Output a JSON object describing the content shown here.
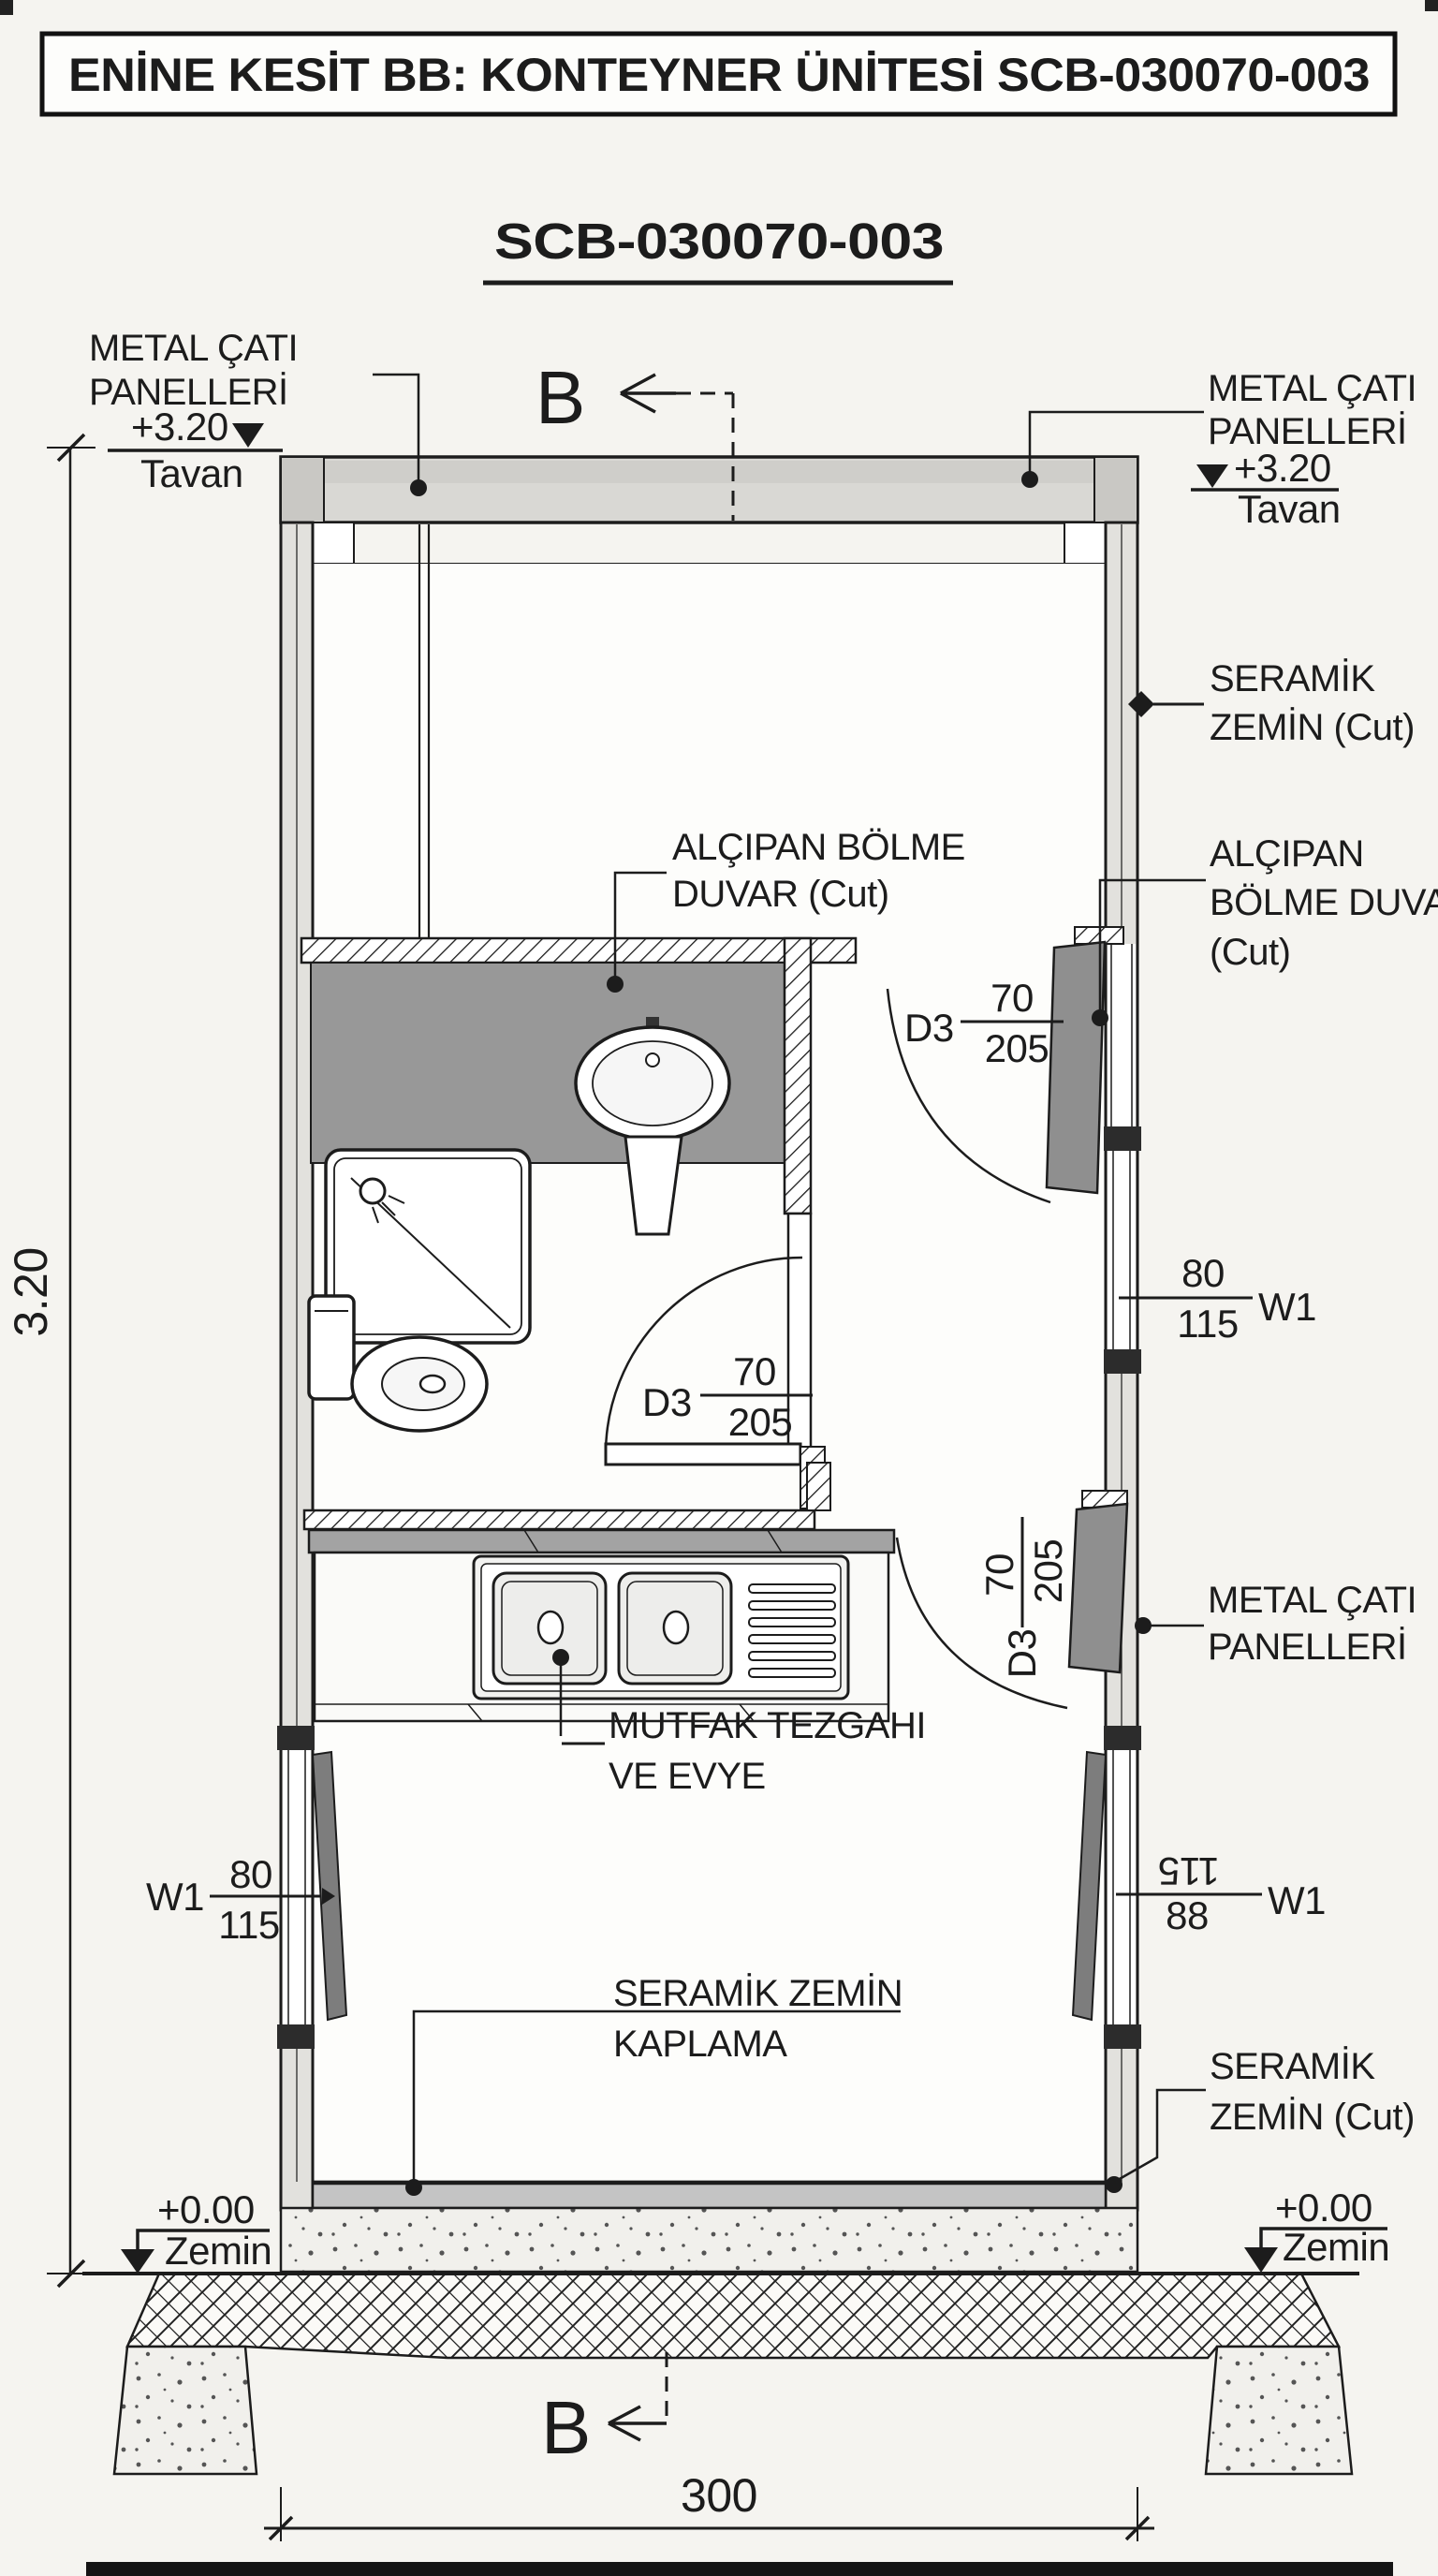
{
  "title": "ENİNE KESİT BB: KONTEYNER ÜNİTESİ SCB-030070-003",
  "drawing_code": "SCB-030070-003",
  "section": {
    "marker": "B"
  },
  "levels": {
    "ceiling": {
      "value": "+3.20",
      "name": "Tavan"
    },
    "ground": {
      "value": "+0.00",
      "name": "Zemin"
    }
  },
  "dimensions": {
    "height": "3.20",
    "width": "300"
  },
  "doors": {
    "d3": {
      "tag": "D3",
      "width": "70",
      "height": "205"
    }
  },
  "windows": {
    "w1": {
      "tag": "W1",
      "width": "80",
      "height": "115"
    },
    "w1_flipped": {
      "tag": "W1",
      "num": "115",
      "den": "88"
    }
  },
  "callouts": {
    "roof_panels": {
      "line1": "METAL ÇATI",
      "line2": "PANELLERİ"
    },
    "ceramic_cut": {
      "line1": "SERAMİK",
      "line2": "ZEMİN (Cut)"
    },
    "partition_two": {
      "line1": "ALÇIPAN BÖLME",
      "line2": "DUVAR (Cut)"
    },
    "partition_three": {
      "line1": "ALÇIPAN",
      "line2": "BÖLME DUVAR",
      "line3": "(Cut)"
    },
    "kitchen": {
      "line1": "MUTFAK TEZGAHI",
      "line2": "VE EVYE"
    },
    "ceramic_floor": {
      "line1": "SERAMİK ZEMİN",
      "line2": "KAPLAMA"
    }
  },
  "colors": {
    "ink": "#1c1c1c",
    "paper": "#f5f4f0",
    "wall_fill": "#e2e1dd",
    "roof_fill": "#d9d8d4",
    "partition_gray": "#989898",
    "door_gray": "#8f8f8f",
    "counter_edge": "#a3a3a3",
    "floor_band": "#c4c4c4",
    "window_pane": "#7d7d7d",
    "sill_block": "#2c2c2c"
  }
}
